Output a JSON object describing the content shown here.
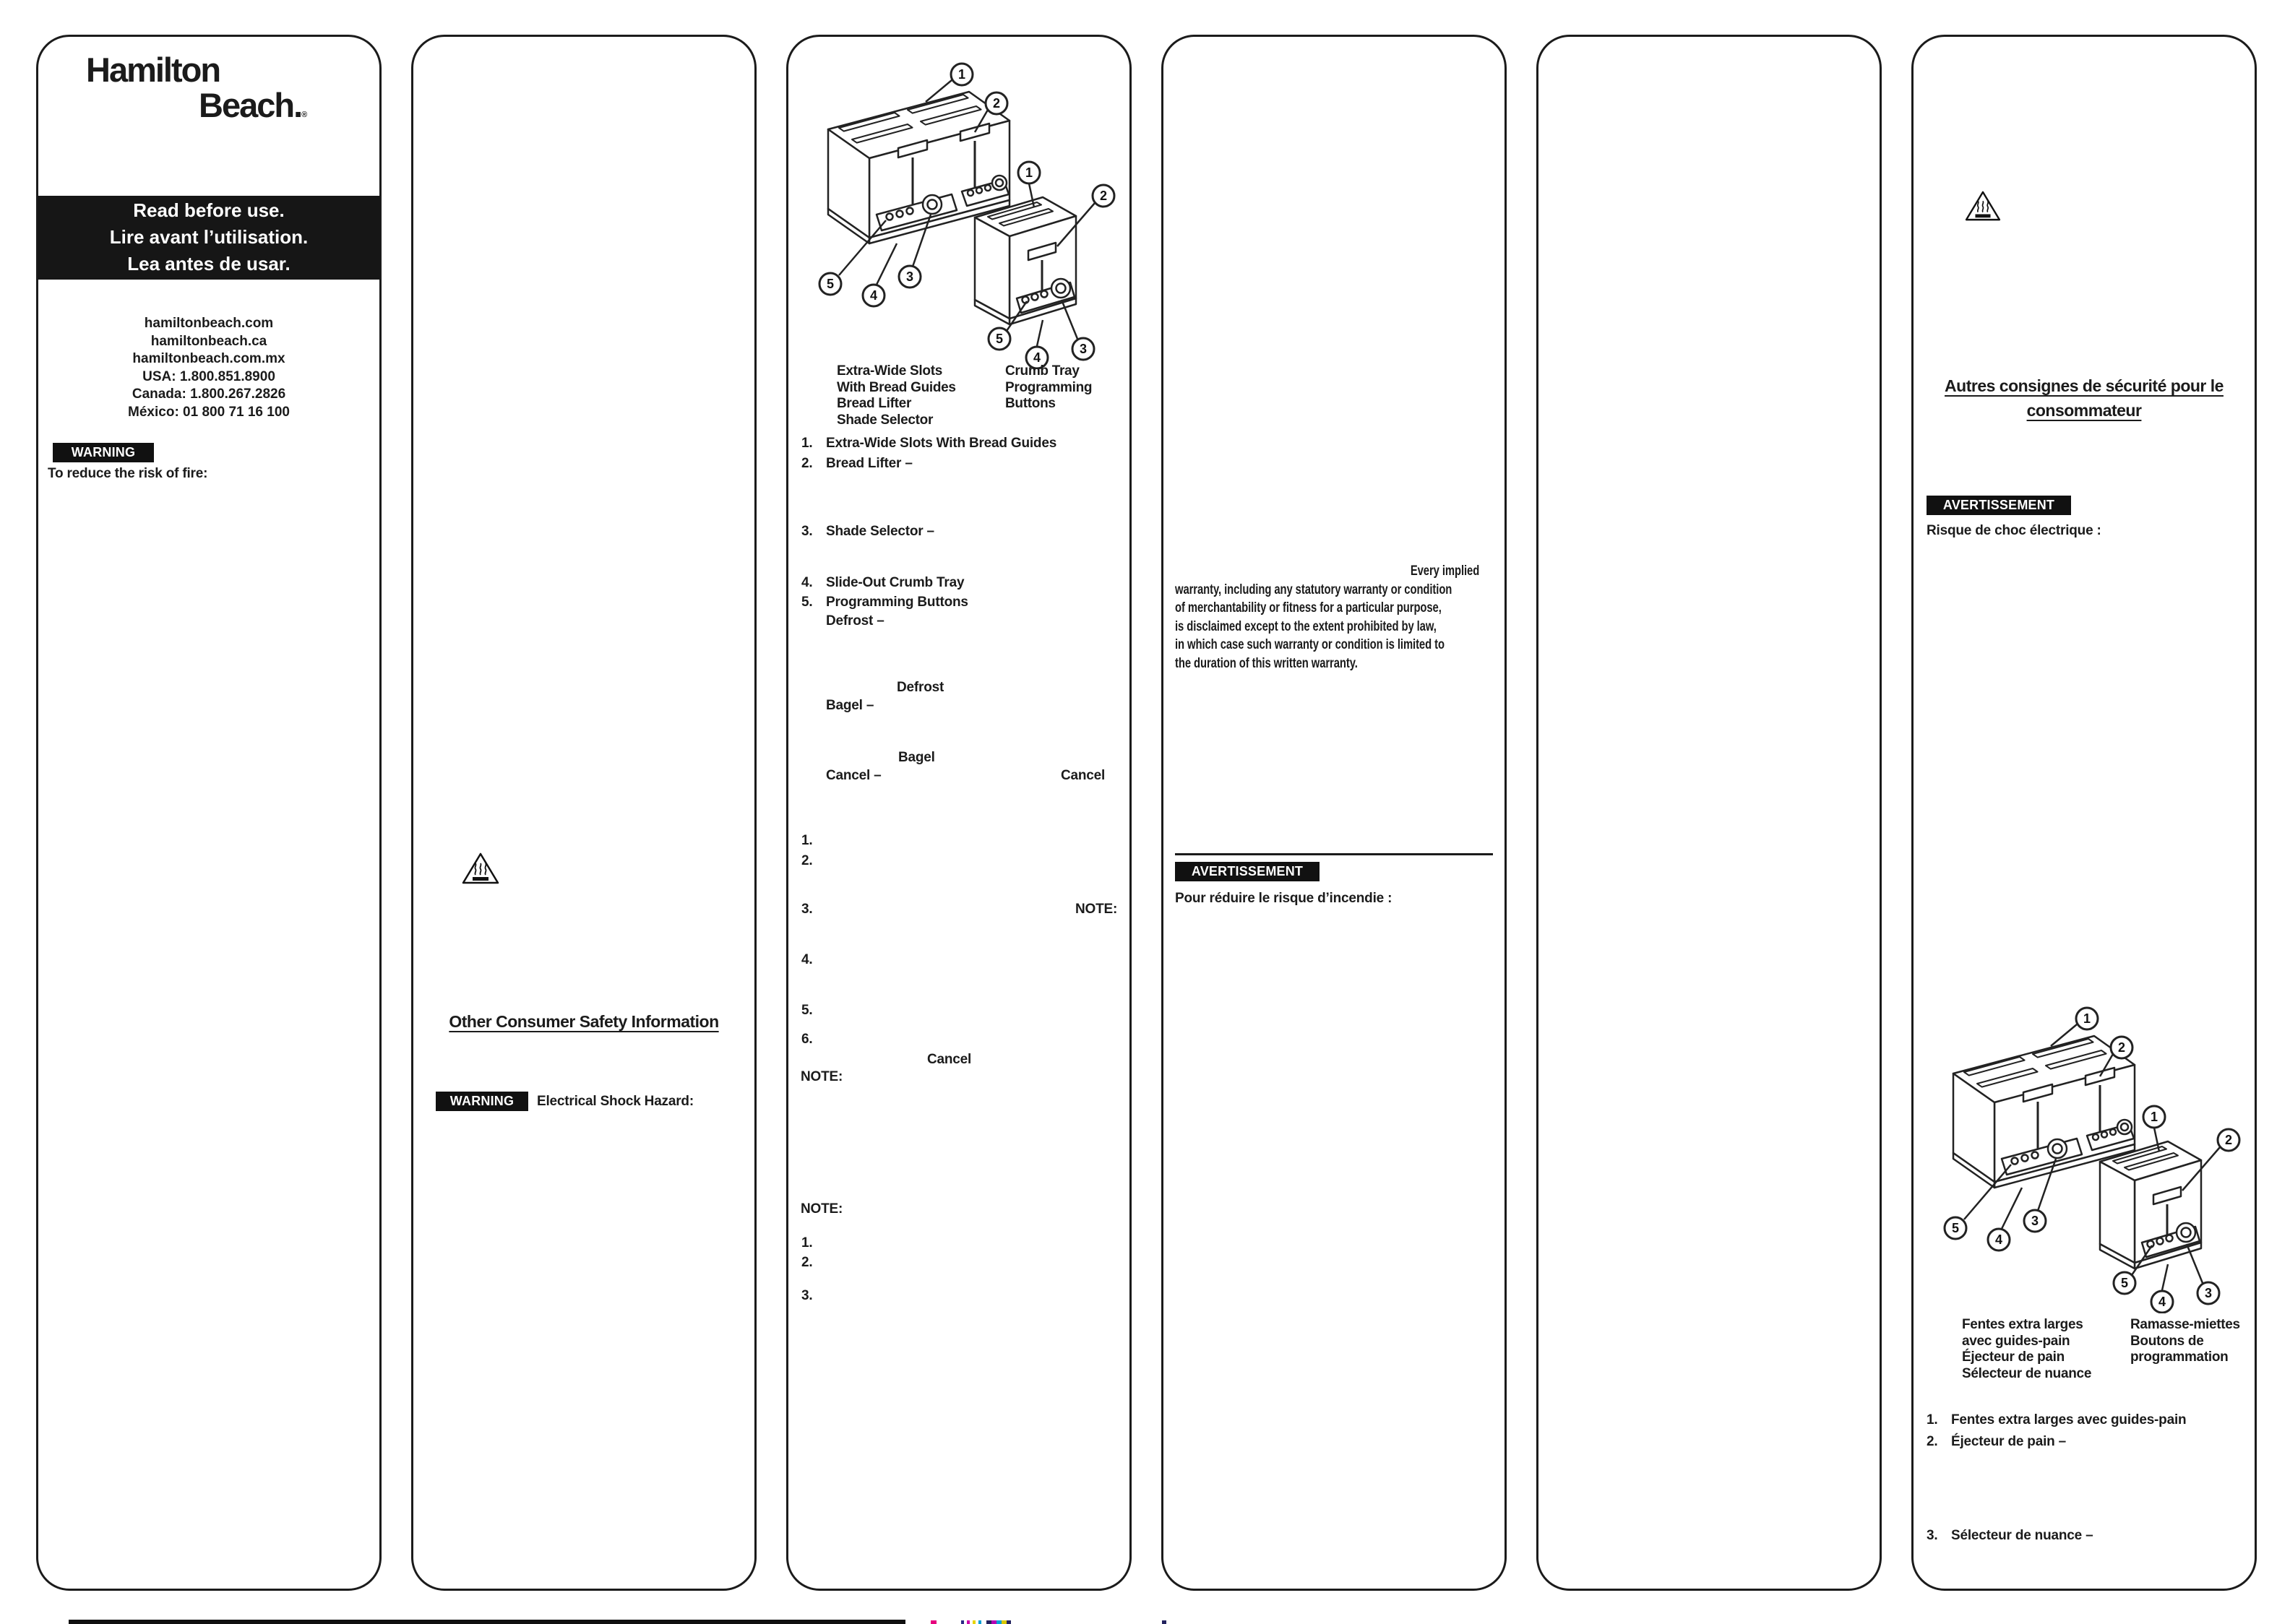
{
  "colors": {
    "ink": "#1b1b1b",
    "paper": "#ffffff"
  },
  "brand": {
    "name_line1": "Hamilton",
    "name_line2": "Beach.",
    "trademark": "®"
  },
  "panel1": {
    "read_before_lines": [
      "Read before use.",
      "Lire avant l’utilisation.",
      "Lea antes de usar."
    ],
    "contact_lines": [
      "hamiltonbeach.com",
      "hamiltonbeach.ca",
      "hamiltonbeach.com.mx",
      "USA: 1.800.851.8900",
      "Canada: 1.800.267.2826",
      "México: 01 800 71 16 100"
    ],
    "warning_badge": "WARNING",
    "warning_text": "To reduce the risk of fire:"
  },
  "panel2": {
    "heading": "Other Consumer Safety Information",
    "warning_badge": "WARNING",
    "warning_text": "Electrical Shock Hazard:"
  },
  "panel3": {
    "label_col_left": [
      "Extra-Wide Slots",
      "With Bread Guides",
      "Bread Lifter",
      "Shade Selector"
    ],
    "label_col_right": [
      "Crumb Tray",
      "Programming",
      "Buttons"
    ],
    "parts": [
      {
        "num": "1.",
        "text": "Extra-Wide Slots With Bread Guides"
      },
      {
        "num": "2.",
        "text": "Bread Lifter –"
      },
      {
        "num": "3.",
        "text": "Shade Selector –"
      },
      {
        "num": "4.",
        "text": "Slide-Out Crumb Tray"
      },
      {
        "num": "5.",
        "text": "Programming Buttons"
      }
    ],
    "defrost_dash": "Defrost –",
    "defrost": "Defrost",
    "bagel_dash": "Bagel –",
    "bagel": "Bagel",
    "cancel_dash": "Cancel –",
    "cancel": "Cancel",
    "step_nums": [
      "1.",
      "2.",
      "3.",
      "4.",
      "5.",
      "6."
    ],
    "note": "NOTE:",
    "cancel2": "Cancel",
    "note2": "NOTE:",
    "note3": "NOTE:",
    "end_nums": [
      "1.",
      "2.",
      "3."
    ]
  },
  "panel4": {
    "warranty_lines": [
      "Every implied",
      "warranty, including any statutory warranty or condition",
      "of merchantability or fitness for a particular purpose,",
      "is disclaimed except to the extent prohibited by law,",
      "in which case such warranty or condition is limited to",
      "the duration of this written warranty."
    ],
    "avertissement_badge": "AVERTISSEMENT",
    "warning_text": "Pour réduire le risque d’incendie :"
  },
  "panel6": {
    "heading_lines": [
      "Autres consignes de sécurité pour le",
      "consommateur"
    ],
    "avertissement_badge": "AVERTISSEMENT",
    "warning_text": "Risque de choc électrique :",
    "label_col_left": [
      "Fentes extra larges",
      "avec guides-pain",
      "Éjecteur de pain",
      "Sélecteur de nuance"
    ],
    "label_col_right": [
      "Ramasse-miettes",
      "Boutons de",
      "programmation"
    ],
    "parts": [
      {
        "num": "1.",
        "text": "Fentes extra larges avec guides-pain"
      },
      {
        "num": "2.",
        "text": "Éjecteur de pain –"
      },
      {
        "num": "3.",
        "text": "Sélecteur de nuance –"
      }
    ]
  },
  "diagram": {
    "callouts": [
      "1",
      "2",
      "3",
      "4",
      "5"
    ]
  }
}
